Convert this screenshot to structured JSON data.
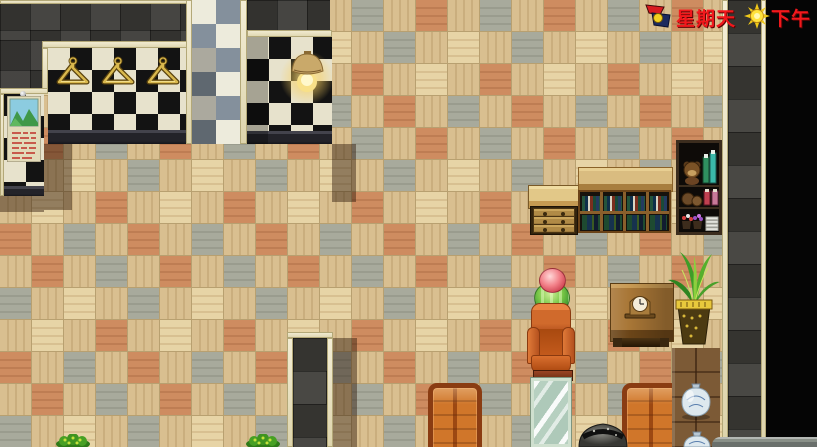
{
  "app": {
    "name": "rpg-room-scene",
    "type": "game-screenshot",
    "language": "zh"
  },
  "hud": {
    "day": {
      "icon": "flags-icon",
      "label": "星期天",
      "color": "#f2181c"
    },
    "time": {
      "icon": "sun-icon",
      "label": "下午",
      "color": "#f2181c"
    }
  },
  "palette": {
    "floor_tan": "#d9bf90",
    "floor_light": "#e7d4a6",
    "floor_orange": "#ce8c60",
    "floor_gray": "#a8aa9c",
    "trim_cream": "#ece4c2",
    "checker_dark": "#131313",
    "checker_light": "#e7e2cc",
    "diamond_gray": "#84909c",
    "wall_stone": "#3a3936",
    "void_black": "#050505",
    "hud_text_red": "#f2181c"
  },
  "scene": {
    "objects": [
      {
        "name": "coat-hangers",
        "count": 3,
        "color": "#d9b84e"
      },
      {
        "name": "wall-lamp",
        "state": "lit"
      },
      {
        "name": "poster",
        "motif": "mountain-landscape"
      },
      {
        "name": "dresser",
        "drawers": 3
      },
      {
        "name": "bookshelf",
        "rows": 2,
        "compartments": 8
      },
      {
        "name": "display-cabinet",
        "rows": 3
      },
      {
        "name": "side-table-with-clock"
      },
      {
        "name": "potted-palm"
      },
      {
        "name": "flower-topiary",
        "colors": [
          "#f28088",
          "#7ac848"
        ]
      },
      {
        "name": "armchair",
        "color": "#d0762a"
      },
      {
        "name": "standing-mirror"
      },
      {
        "name": "leather-sofa",
        "count": 2,
        "color": "#d0762a"
      },
      {
        "name": "stone-urn"
      },
      {
        "name": "porcelain-vase",
        "count": 2
      },
      {
        "name": "floor-bush",
        "count": 2
      }
    ]
  }
}
